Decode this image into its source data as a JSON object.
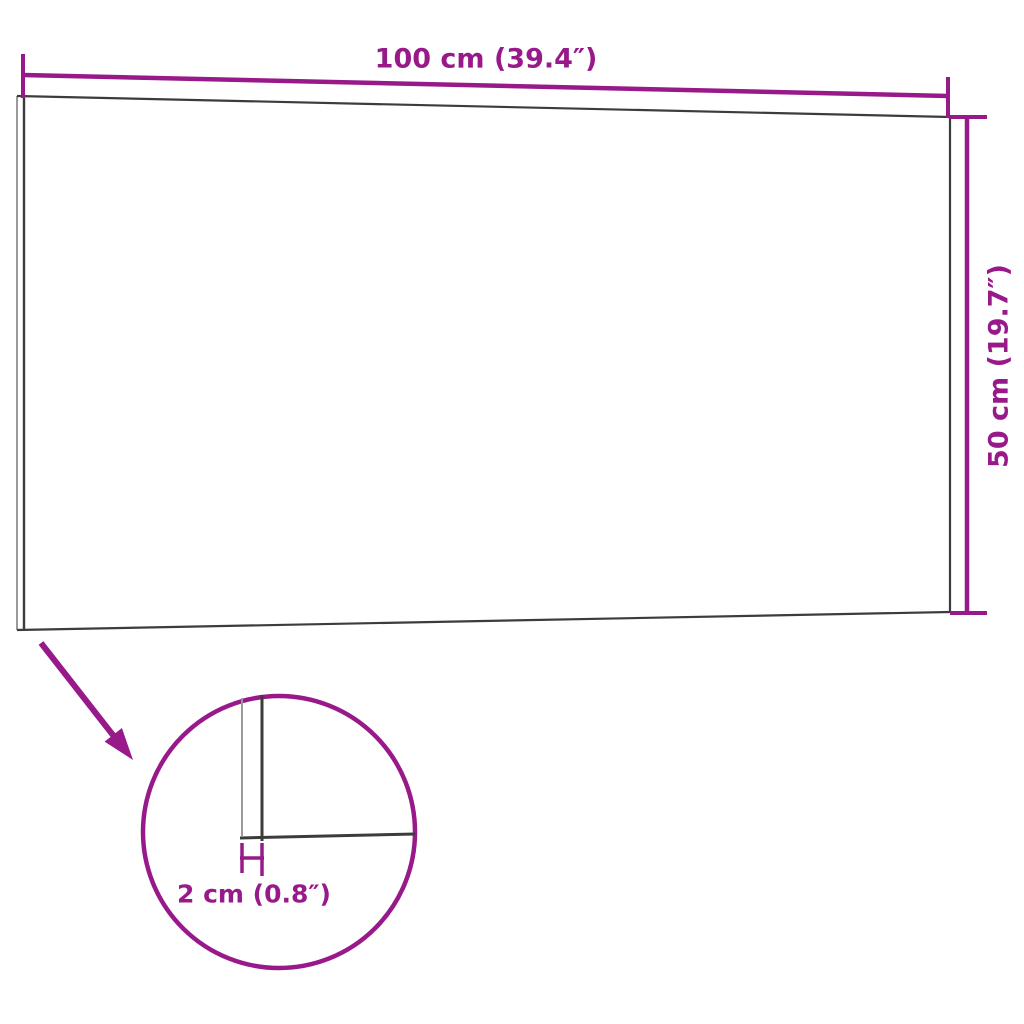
{
  "labels": {
    "width": "100 cm (39.4″)",
    "height": "50 cm (19.7″)",
    "thickness": "2 cm (0.8″)"
  },
  "colors": {
    "accent": "#981A8A",
    "line_dark": "#3C3C3B",
    "line_light": "#9A9A9A",
    "background": "#FFFFFF"
  }
}
